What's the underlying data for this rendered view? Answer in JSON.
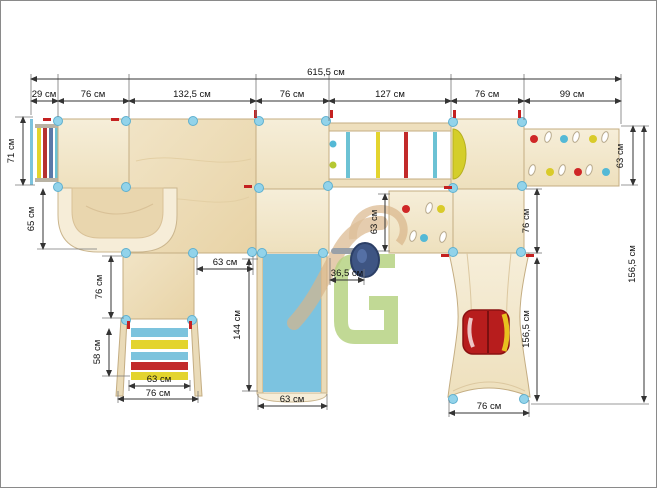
{
  "drawing": {
    "type": "playground-complex-plan-top-view",
    "units": "см",
    "dims": {
      "total_width": "615,5 см",
      "seg_1": "29 см",
      "seg_2": "76 см",
      "seg_3": "132,5 см",
      "seg_4": "76 см",
      "seg_5": "127 см",
      "seg_6": "76 см",
      "seg_7": "99 см",
      "left_ladder_height": "71 см",
      "tunnel_height": "65 см",
      "lower_tower_height": "76 см",
      "ladder_length": "58 см",
      "ladder_width_inner": "63 см",
      "ladder_width_outer": "76 см",
      "platform_opening": "63 см",
      "slide_length": "144 см",
      "slide_width": "63 см",
      "wheel_offset": "36,5 см",
      "mid_panel_height": "63 см",
      "right_tower_height": "76 см",
      "right_panel_height": "63 см",
      "tube_length": "156,5 см",
      "tube_width": "76 см",
      "total_depth": "156,5 см"
    },
    "colors": {
      "wood_light": "#f5ecd6",
      "wood_dark": "#e9d5ab",
      "wood_edge": "#c4ad82",
      "post_blue": "#92d3ea",
      "slide_blue": "#7cc3e0",
      "accent_red": "#c42121",
      "accent_yellow": "#e0d02e",
      "accent_cyan": "#5dbcd8",
      "seat_red": "#b71d1d",
      "wheel_navy": "#3e5583",
      "watermark_tan": "#d8b488",
      "watermark_green": "#a9ca6c"
    }
  }
}
